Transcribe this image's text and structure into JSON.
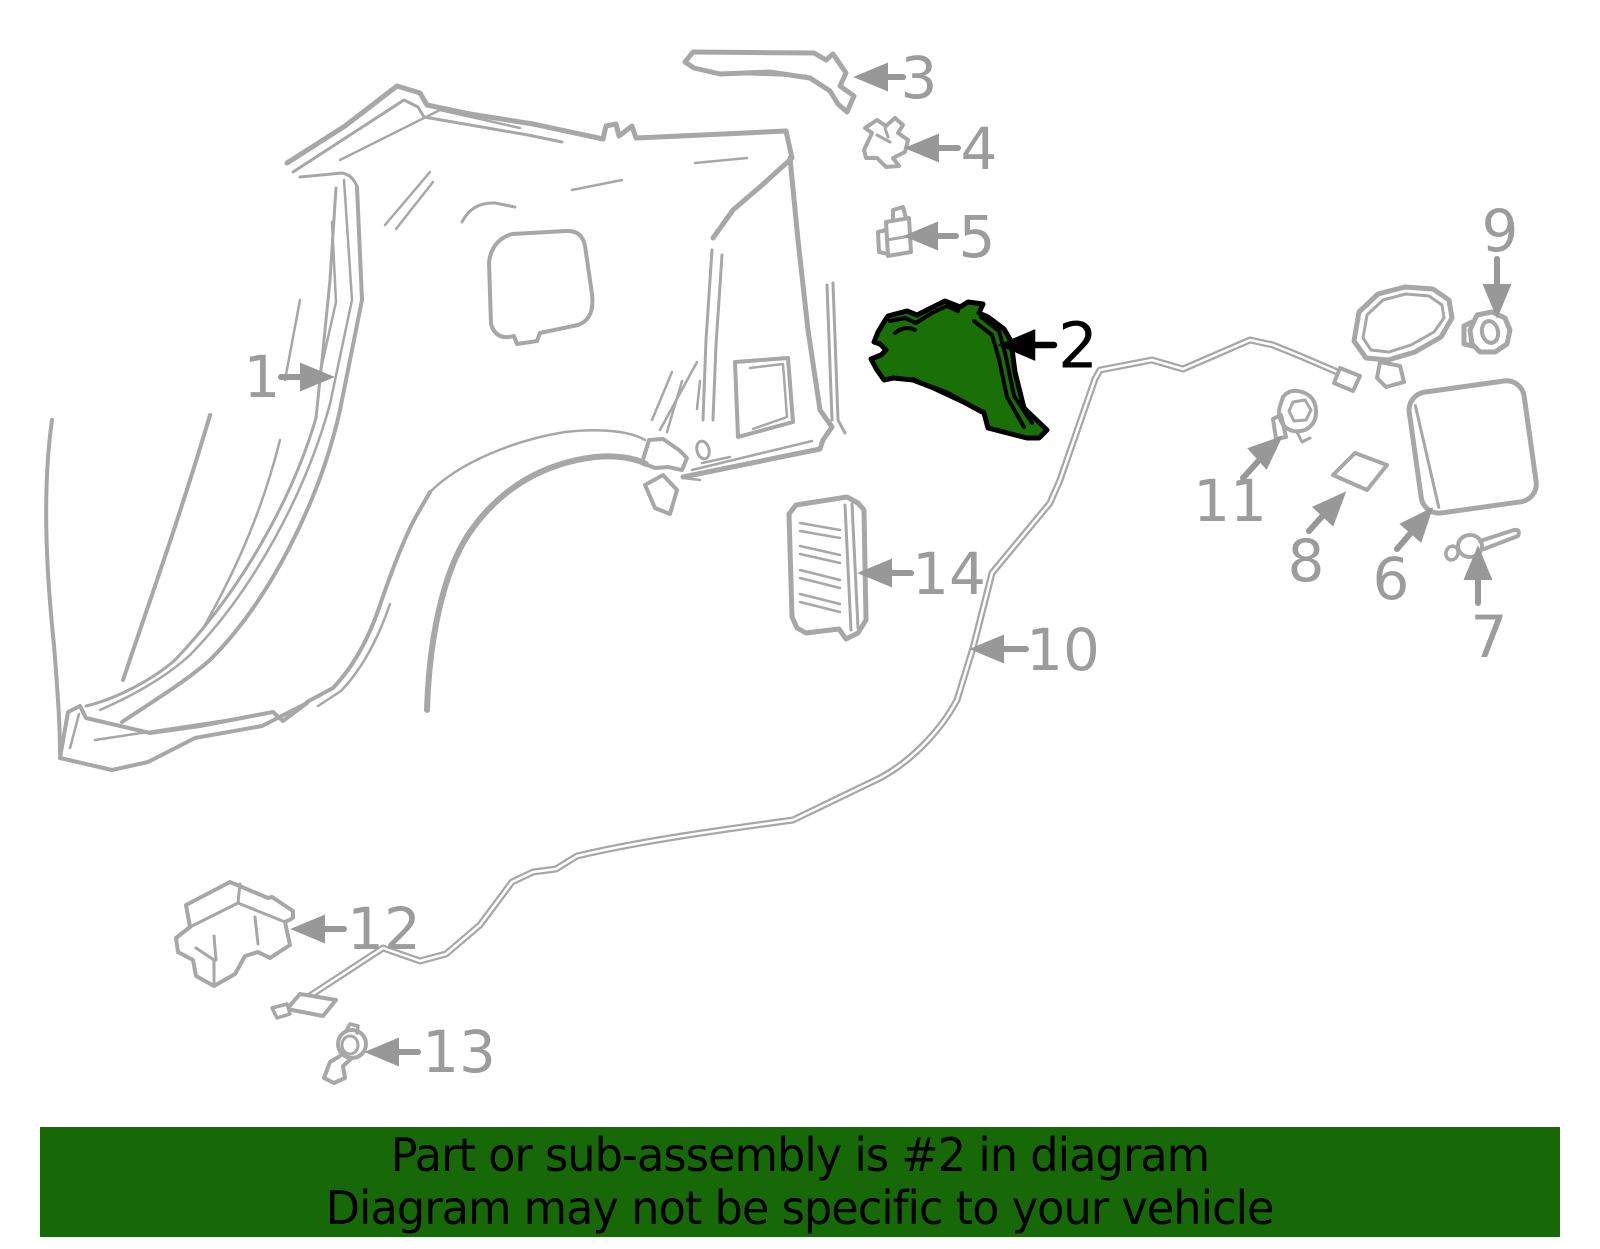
{
  "diagram": {
    "type": "vehicle-quarter-panel-parts-diagram",
    "highlighted_part_number": "2",
    "colors": {
      "line_gray": "#a7a7a7",
      "label_gray": "#9c9c9c",
      "highlight_fill_green": "#187006",
      "highlight_outline_black": "#000000",
      "banner_green": "#176908",
      "banner_text_black": "#000000"
    },
    "callouts": [
      {
        "label": "1"
      },
      {
        "label": "2"
      },
      {
        "label": "3"
      },
      {
        "label": "4"
      },
      {
        "label": "5"
      },
      {
        "label": "6"
      },
      {
        "label": "7"
      },
      {
        "label": "8"
      },
      {
        "label": "9"
      },
      {
        "label": "10"
      },
      {
        "label": "11"
      },
      {
        "label": "12"
      },
      {
        "label": "13"
      },
      {
        "label": "14"
      }
    ]
  },
  "banner": {
    "line1": "Part or sub-assembly is #2 in diagram",
    "line2": "Diagram may not be specific to your vehicle"
  }
}
